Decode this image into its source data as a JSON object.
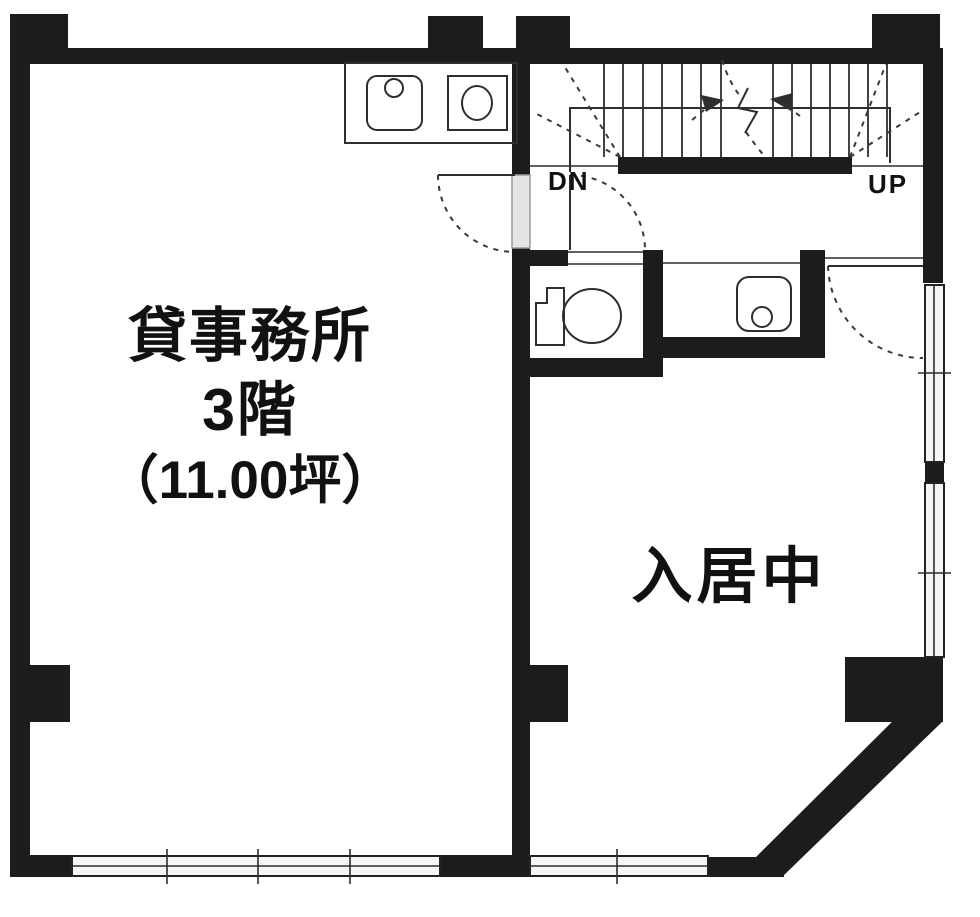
{
  "labels": {
    "office_room": {
      "line1": "貸事務所",
      "line2": "3階",
      "line3": "（11.00坪）"
    },
    "right_room": "入居中",
    "stairs": {
      "down": "DN",
      "up": "UP"
    }
  },
  "colors": {
    "wall": "#1c1c1c",
    "line": "#2e2e2e",
    "background": "#ffffff",
    "window_fill": "#f5f5f5",
    "door_fill": "#e4e4e4",
    "dash": "#3a3a3a"
  }
}
